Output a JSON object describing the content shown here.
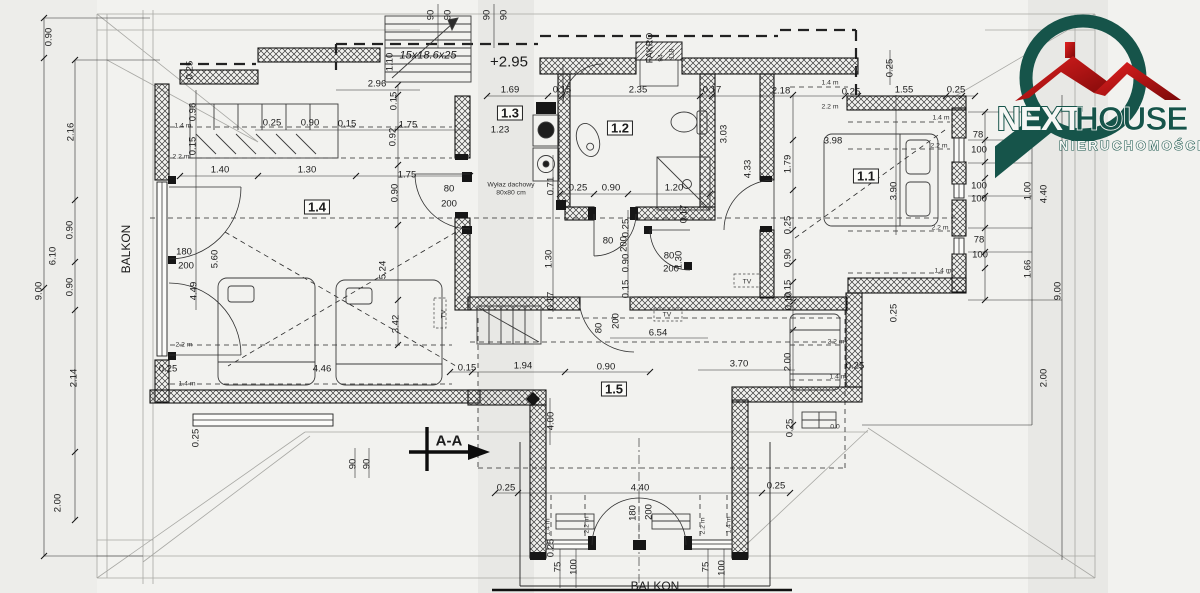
{
  "logo": {
    "next": "NEXT",
    "house": "HOUSE",
    "subtitle": "NIERUCHOMOŚCI"
  },
  "colors": {
    "teal": "#16544a",
    "red": "#cc1414",
    "line": "#1c1c1c",
    "paper": "#f2f2ef"
  },
  "plan": {
    "rooms": [
      "1.1",
      "1.2",
      "1.3",
      "1.4",
      "1.5"
    ],
    "labels": [
      {
        "t": "90",
        "x": 431,
        "y": 15,
        "r": -90
      },
      {
        "t": "90",
        "x": 448,
        "y": 15,
        "r": -90
      },
      {
        "t": "90",
        "x": 487,
        "y": 15,
        "r": -90
      },
      {
        "t": "90",
        "x": 504,
        "y": 15,
        "r": -90
      },
      {
        "t": "15x18.6x25",
        "x": 428,
        "y": 56,
        "k": "ann",
        "s": 11,
        "i": 1
      },
      {
        "t": "+2.95",
        "x": 509,
        "y": 62,
        "k": "ann",
        "s": 15
      },
      {
        "t": "2.96",
        "x": 377,
        "y": 84
      },
      {
        "t": "1.10",
        "x": 390,
        "y": 62,
        "r": -90
      },
      {
        "t": "0.25",
        "x": 190,
        "y": 70,
        "r": -90
      },
      {
        "t": "1.69",
        "x": 510,
        "y": 90
      },
      {
        "t": "0.15",
        "x": 562,
        "y": 90
      },
      {
        "t": "2.35",
        "x": 638,
        "y": 90
      },
      {
        "t": "0.17",
        "x": 712,
        "y": 90
      },
      {
        "t": "2.18",
        "x": 781,
        "y": 91
      },
      {
        "t": "0.25",
        "x": 851,
        "y": 92
      },
      {
        "t": "1.55",
        "x": 904,
        "y": 90
      },
      {
        "t": "0.25",
        "x": 956,
        "y": 90
      },
      {
        "t": "FAKRO",
        "x": 650,
        "y": 48,
        "r": -90,
        "k": "ann",
        "s": 9
      },
      {
        "t": "94",
        "x": 662,
        "y": 58,
        "r": -90,
        "k": "sm"
      },
      {
        "t": "118",
        "x": 673,
        "y": 54,
        "r": -90,
        "k": "sm"
      },
      {
        "t": "0.25",
        "x": 890,
        "y": 68,
        "r": -90
      },
      {
        "t": "1.4 m",
        "x": 830,
        "y": 84,
        "k": "sm"
      },
      {
        "t": "2.2 m",
        "x": 830,
        "y": 108,
        "k": "sm"
      },
      {
        "t": "0.90",
        "x": 49,
        "y": 37,
        "r": -90
      },
      {
        "t": "2.16",
        "x": 71,
        "y": 132,
        "r": -90
      },
      {
        "t": "0.90",
        "x": 70,
        "y": 230,
        "r": -90
      },
      {
        "t": "6.10",
        "x": 53,
        "y": 256,
        "r": -90
      },
      {
        "t": "0.90",
        "x": 70,
        "y": 287,
        "r": -90
      },
      {
        "t": "9.00",
        "x": 39,
        "y": 291,
        "r": -90
      },
      {
        "t": "BALKON",
        "x": 126,
        "y": 249,
        "r": -90,
        "k": "ann",
        "s": 12
      },
      {
        "t": "2.14",
        "x": 74,
        "y": 378,
        "r": -90
      },
      {
        "t": "2.00",
        "x": 58,
        "y": 503,
        "r": -90
      },
      {
        "t": "1.4 m",
        "x": 183,
        "y": 127,
        "k": "sm"
      },
      {
        "t": "0.96",
        "x": 193,
        "y": 112,
        "r": -90
      },
      {
        "t": "0.15",
        "x": 193,
        "y": 146,
        "r": -90
      },
      {
        "t": "2.2 m",
        "x": 181,
        "y": 158,
        "k": "sm"
      },
      {
        "t": "0.25",
        "x": 272,
        "y": 123
      },
      {
        "t": "0.90",
        "x": 310,
        "y": 123
      },
      {
        "t": "0.15",
        "x": 347,
        "y": 124
      },
      {
        "t": "1.75",
        "x": 408,
        "y": 125
      },
      {
        "t": "1.40",
        "x": 220,
        "y": 170
      },
      {
        "t": "1.30",
        "x": 307,
        "y": 170
      },
      {
        "t": "1.75",
        "x": 407,
        "y": 175
      },
      {
        "t": "0.92",
        "x": 393,
        "y": 137,
        "r": -90
      },
      {
        "t": "0.15",
        "x": 394,
        "y": 101,
        "r": -90
      },
      {
        "t": "0.90",
        "x": 395,
        "y": 193,
        "r": -90
      },
      {
        "t": "180",
        "x": 184,
        "y": 252
      },
      {
        "t": "200",
        "x": 186,
        "y": 266
      },
      {
        "t": "5.60",
        "x": 215,
        "y": 259,
        "r": -90
      },
      {
        "t": "4.49",
        "x": 194,
        "y": 291,
        "r": -90
      },
      {
        "t": "5.24",
        "x": 383,
        "y": 270,
        "r": -90
      },
      {
        "t": "3.42",
        "x": 396,
        "y": 324,
        "r": -90
      },
      {
        "t": "2.2 m",
        "x": 184,
        "y": 346,
        "k": "sm"
      },
      {
        "t": "0.25",
        "x": 168,
        "y": 369
      },
      {
        "t": "1.4 m",
        "x": 187,
        "y": 385,
        "k": "sm"
      },
      {
        "t": "4.46",
        "x": 322,
        "y": 369
      },
      {
        "t": "0.15",
        "x": 467,
        "y": 368
      },
      {
        "t": "0.25",
        "x": 196,
        "y": 438,
        "r": -90
      },
      {
        "t": "90",
        "x": 353,
        "y": 464,
        "r": -90
      },
      {
        "t": "90",
        "x": 367,
        "y": 464,
        "r": -90
      },
      {
        "t": "80",
        "x": 449,
        "y": 189
      },
      {
        "t": "200",
        "x": 449,
        "y": 204
      },
      {
        "t": "Wyłaz dachowy",
        "x": 511,
        "y": 186,
        "k": "sm"
      },
      {
        "t": "80x80 cm",
        "x": 511,
        "y": 194,
        "k": "sm"
      },
      {
        "t": "0.71",
        "x": 551,
        "y": 186,
        "r": -90
      },
      {
        "t": "1.23",
        "x": 500,
        "y": 130
      },
      {
        "t": "1.30",
        "x": 549,
        "y": 259,
        "r": -90
      },
      {
        "t": "0.17",
        "x": 551,
        "y": 301,
        "r": -90
      },
      {
        "t": "TV",
        "x": 445,
        "y": 314,
        "r": -90,
        "k": "sm"
      },
      {
        "t": "0.25",
        "x": 578,
        "y": 188
      },
      {
        "t": "0.90",
        "x": 611,
        "y": 188
      },
      {
        "t": "1.20",
        "x": 674,
        "y": 188
      },
      {
        "t": "0.17",
        "x": 684,
        "y": 214,
        "r": -90
      },
      {
        "t": "0.25",
        "x": 626,
        "y": 228,
        "r": -90
      },
      {
        "t": "80",
        "x": 608,
        "y": 241
      },
      {
        "t": "200",
        "x": 624,
        "y": 244,
        "r": -90
      },
      {
        "t": "0.90",
        "x": 626,
        "y": 263,
        "r": -90
      },
      {
        "t": "0.15",
        "x": 626,
        "y": 289,
        "r": -90
      },
      {
        "t": "80",
        "x": 669,
        "y": 256
      },
      {
        "t": "200",
        "x": 671,
        "y": 269
      },
      {
        "t": "1.30",
        "x": 679,
        "y": 260,
        "r": -90
      },
      {
        "t": "3.03",
        "x": 724,
        "y": 134,
        "r": -90
      },
      {
        "t": "4.33",
        "x": 748,
        "y": 169,
        "r": -90
      },
      {
        "t": "1.79",
        "x": 788,
        "y": 164,
        "r": -90
      },
      {
        "t": "0.25",
        "x": 788,
        "y": 225,
        "r": -90
      },
      {
        "t": "0.90",
        "x": 788,
        "y": 258,
        "r": -90
      },
      {
        "t": "0.15",
        "x": 788,
        "y": 289,
        "r": -90
      },
      {
        "t": "0.10",
        "x": 789,
        "y": 301,
        "r": -90
      },
      {
        "t": "TV",
        "x": 747,
        "y": 283,
        "k": "sm"
      },
      {
        "t": "TV",
        "x": 667,
        "y": 316,
        "k": "sm"
      },
      {
        "t": "80",
        "x": 599,
        "y": 328,
        "r": -90
      },
      {
        "t": "200",
        "x": 616,
        "y": 321,
        "r": -90
      },
      {
        "t": "6.54",
        "x": 658,
        "y": 333
      },
      {
        "t": "1.94",
        "x": 523,
        "y": 366
      },
      {
        "t": "0.90",
        "x": 606,
        "y": 367
      },
      {
        "t": "2.00",
        "x": 788,
        "y": 362,
        "r": -90
      },
      {
        "t": "3.70",
        "x": 739,
        "y": 364
      },
      {
        "t": "2.2 m",
        "x": 836,
        "y": 343,
        "k": "sm"
      },
      {
        "t": "0.25",
        "x": 855,
        "y": 366
      },
      {
        "t": "1.4 m",
        "x": 838,
        "y": 378,
        "k": "sm"
      },
      {
        "t": "0 0",
        "x": 835,
        "y": 428,
        "k": "sm"
      },
      {
        "t": "0.25",
        "x": 790,
        "y": 428,
        "r": -90
      },
      {
        "t": "4.00",
        "x": 551,
        "y": 421,
        "r": -90
      },
      {
        "t": "A-A",
        "x": 449,
        "y": 441,
        "k": "ann",
        "s": 15,
        "b": 1
      },
      {
        "t": "3.98",
        "x": 833,
        "y": 141
      },
      {
        "t": "3.90",
        "x": 894,
        "y": 191,
        "r": -90
      },
      {
        "t": "1.4 m",
        "x": 941,
        "y": 119,
        "k": "sm"
      },
      {
        "t": "2.2 m",
        "x": 939,
        "y": 147,
        "k": "sm"
      },
      {
        "t": "2.2 m",
        "x": 940,
        "y": 229,
        "k": "sm"
      },
      {
        "t": "1.4 m",
        "x": 943,
        "y": 272,
        "k": "sm"
      },
      {
        "t": "78",
        "x": 978,
        "y": 135
      },
      {
        "t": "100",
        "x": 979,
        "y": 150
      },
      {
        "t": "100",
        "x": 979,
        "y": 186
      },
      {
        "t": "100",
        "x": 979,
        "y": 199
      },
      {
        "t": "78",
        "x": 979,
        "y": 240
      },
      {
        "t": "100",
        "x": 980,
        "y": 255
      },
      {
        "t": "1.00",
        "x": 1028,
        "y": 191,
        "r": -90
      },
      {
        "t": "4.40",
        "x": 1044,
        "y": 194,
        "r": -90
      },
      {
        "t": "1.66",
        "x": 1028,
        "y": 269,
        "r": -90
      },
      {
        "t": "9.00",
        "x": 1058,
        "y": 291,
        "r": -90
      },
      {
        "t": "2.00",
        "x": 1044,
        "y": 378,
        "r": -90
      },
      {
        "t": "0.25",
        "x": 894,
        "y": 313,
        "r": -90
      },
      {
        "t": "0.25",
        "x": 506,
        "y": 488
      },
      {
        "t": "4.40",
        "x": 640,
        "y": 488
      },
      {
        "t": "0.25",
        "x": 776,
        "y": 486
      },
      {
        "t": "180",
        "x": 633,
        "y": 513,
        "r": -90
      },
      {
        "t": "200",
        "x": 649,
        "y": 512,
        "r": -90
      },
      {
        "t": "1.4 m",
        "x": 549,
        "y": 527,
        "r": -90,
        "k": "sm"
      },
      {
        "t": "2.2 m",
        "x": 588,
        "y": 525,
        "r": -90,
        "k": "sm"
      },
      {
        "t": "2.2 m",
        "x": 704,
        "y": 526,
        "r": -90,
        "k": "sm"
      },
      {
        "t": "1.4 m",
        "x": 730,
        "y": 525,
        "r": -90,
        "k": "sm"
      },
      {
        "t": "0.25",
        "x": 551,
        "y": 548,
        "r": -90
      },
      {
        "t": "75",
        "x": 558,
        "y": 567,
        "r": -90
      },
      {
        "t": "100",
        "x": 574,
        "y": 567,
        "r": -90
      },
      {
        "t": "75",
        "x": 706,
        "y": 567,
        "r": -90
      },
      {
        "t": "100",
        "x": 722,
        "y": 568,
        "r": -90
      },
      {
        "t": "BALKON",
        "x": 655,
        "y": 586,
        "k": "ann",
        "s": 12
      },
      {
        "t": "1.1",
        "x": 866,
        "y": 176,
        "k": "room"
      },
      {
        "t": "1.2",
        "x": 620,
        "y": 128,
        "k": "room"
      },
      {
        "t": "1.3",
        "x": 510,
        "y": 113,
        "k": "room"
      },
      {
        "t": "1.4",
        "x": 317,
        "y": 207,
        "k": "room"
      },
      {
        "t": "1.5",
        "x": 614,
        "y": 389,
        "k": "room"
      }
    ]
  }
}
